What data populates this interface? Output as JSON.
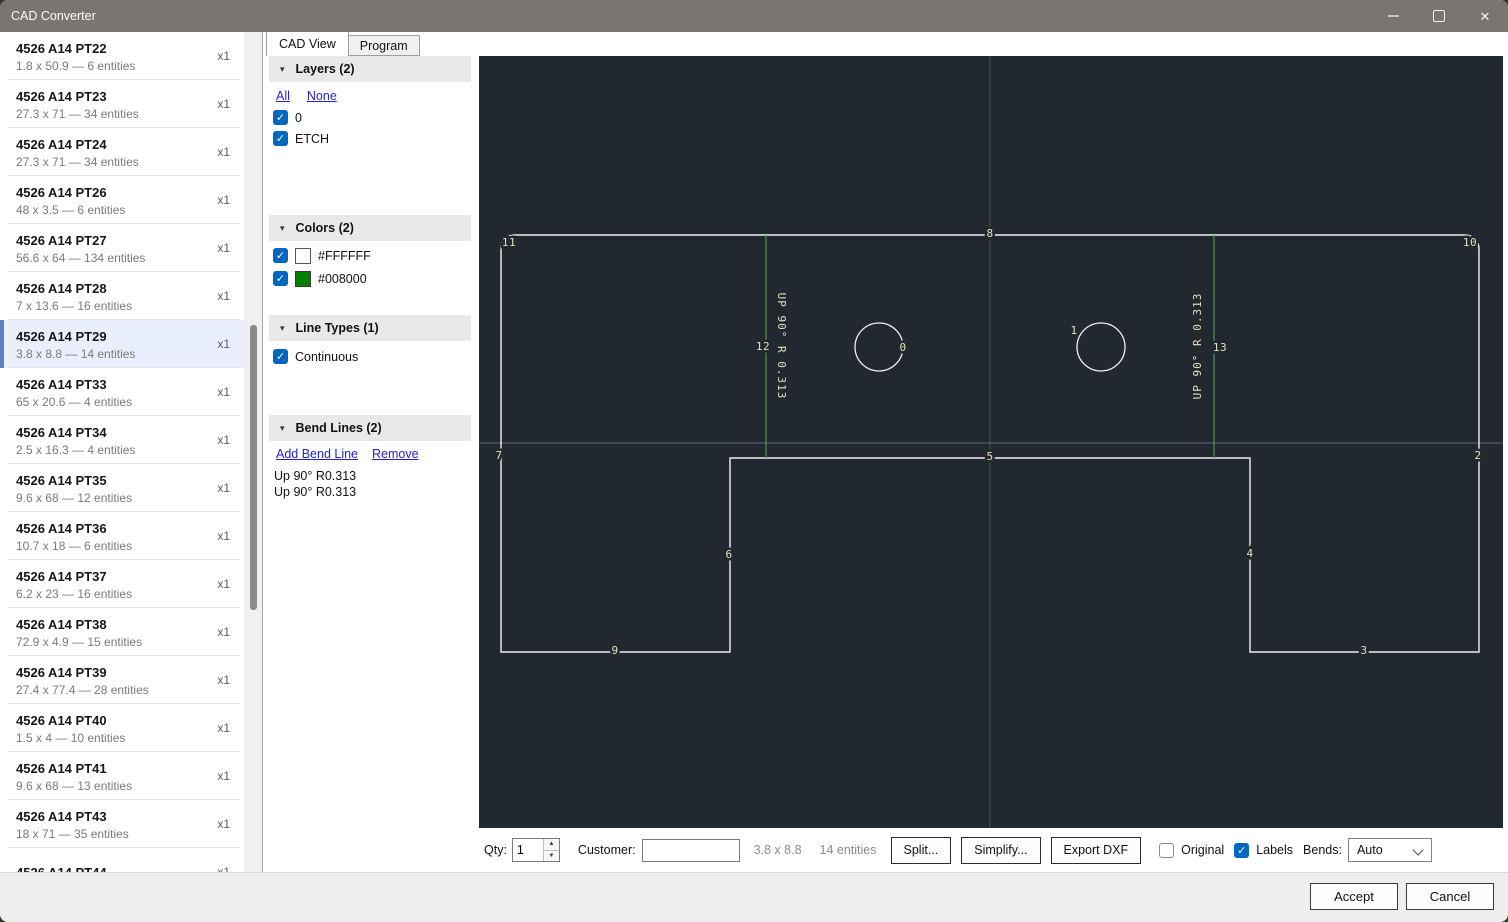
{
  "window": {
    "title": "CAD Converter"
  },
  "icons": {
    "close": "✕",
    "collapse": "▾",
    "check": "✓",
    "spinner_up": "▲",
    "spinner_down": "▼"
  },
  "sidebar": {
    "selected_index": 6,
    "items": [
      {
        "name": "4526 A14 PT22",
        "subtitle": "1.8 x 50.9 — 6 entities",
        "qty": "x1"
      },
      {
        "name": "4526 A14 PT23",
        "subtitle": "27.3 x 71 — 34 entities",
        "qty": "x1"
      },
      {
        "name": "4526 A14 PT24",
        "subtitle": "27.3 x 71 — 34 entities",
        "qty": "x1"
      },
      {
        "name": "4526 A14 PT26",
        "subtitle": "48 x 3.5 — 6 entities",
        "qty": "x1"
      },
      {
        "name": "4526 A14 PT27",
        "subtitle": "56.6 x 64 — 134 entities",
        "qty": "x1"
      },
      {
        "name": "4526 A14 PT28",
        "subtitle": "7 x 13.6 — 16 entities",
        "qty": "x1"
      },
      {
        "name": "4526 A14 PT29",
        "subtitle": "3.8 x 8.8 — 14 entities",
        "qty": "x1"
      },
      {
        "name": "4526 A14 PT33",
        "subtitle": "65 x 20.6 — 4 entities",
        "qty": "x1"
      },
      {
        "name": "4526 A14 PT34",
        "subtitle": "2.5 x 16.3 — 4 entities",
        "qty": "x1"
      },
      {
        "name": "4526 A14 PT35",
        "subtitle": "9.6 x 68 — 12 entities",
        "qty": "x1"
      },
      {
        "name": "4526 A14 PT36",
        "subtitle": "10.7 x 18 — 6 entities",
        "qty": "x1"
      },
      {
        "name": "4526 A14 PT37",
        "subtitle": "6.2 x 23 — 16 entities",
        "qty": "x1"
      },
      {
        "name": "4526 A14 PT38",
        "subtitle": "72.9 x 4.9 — 15 entities",
        "qty": "x1"
      },
      {
        "name": "4526 A14 PT39",
        "subtitle": "27.4 x 77.4 — 28 entities",
        "qty": "x1"
      },
      {
        "name": "4526 A14 PT40",
        "subtitle": "1.5 x 4 — 10 entities",
        "qty": "x1"
      },
      {
        "name": "4526 A14 PT41",
        "subtitle": "9.6 x 68 — 13 entities",
        "qty": "x1"
      },
      {
        "name": "4526 A14 PT43",
        "subtitle": "18 x 71 — 35 entities",
        "qty": "x1"
      },
      {
        "name": "4526 A14 PT44",
        "subtitle": "",
        "qty": "x1"
      }
    ]
  },
  "tabs": {
    "cad_view": "CAD View",
    "program": "Program"
  },
  "panels": {
    "layers": {
      "title": "Layers (2)",
      "links": {
        "all": "All",
        "none": "None"
      },
      "items": [
        {
          "label": "0",
          "checked": true
        },
        {
          "label": "ETCH",
          "checked": true
        }
      ]
    },
    "colors": {
      "title": "Colors (2)",
      "items": [
        {
          "label": "#FFFFFF",
          "swatch": "#FFFFFF",
          "checked": true
        },
        {
          "label": "#008000",
          "swatch": "#008000",
          "checked": true
        }
      ]
    },
    "line_types": {
      "title": "Line Types (1)",
      "items": [
        {
          "label": "Continuous",
          "checked": true
        }
      ]
    },
    "bend_lines": {
      "title": "Bend Lines (2)",
      "links": {
        "add": "Add Bend Line",
        "remove": "Remove"
      },
      "items": [
        "Up 90° R0.313",
        "Up 90° R0.313"
      ]
    }
  },
  "canvas": {
    "background": "#222830",
    "outline_color": "#f0f0f0",
    "bend_color": "#4c8a4c",
    "label_color": "#e2e2b8",
    "bend_label": "UP 90° R 0.313",
    "entity_labels": [
      "0",
      "1",
      "2",
      "3",
      "4",
      "5",
      "6",
      "7",
      "8",
      "9",
      "10",
      "11",
      "12",
      "13"
    ]
  },
  "toolbar": {
    "qty_label": "Qty:",
    "qty_value": "1",
    "customer_label": "Customer:",
    "customer_value": "",
    "size_text": "3.8 x 8.8",
    "entities_text": "14 entities",
    "split_label": "Split...",
    "simplify_label": "Simplify...",
    "export_label": "Export DXF",
    "checkboxes": [
      {
        "label": "Original",
        "checked": false
      },
      {
        "label": "Labels",
        "checked": true
      }
    ],
    "bends_label": "Bends:",
    "bends_value": "Auto"
  },
  "footer": {
    "accept": "Accept",
    "cancel": "Cancel"
  }
}
